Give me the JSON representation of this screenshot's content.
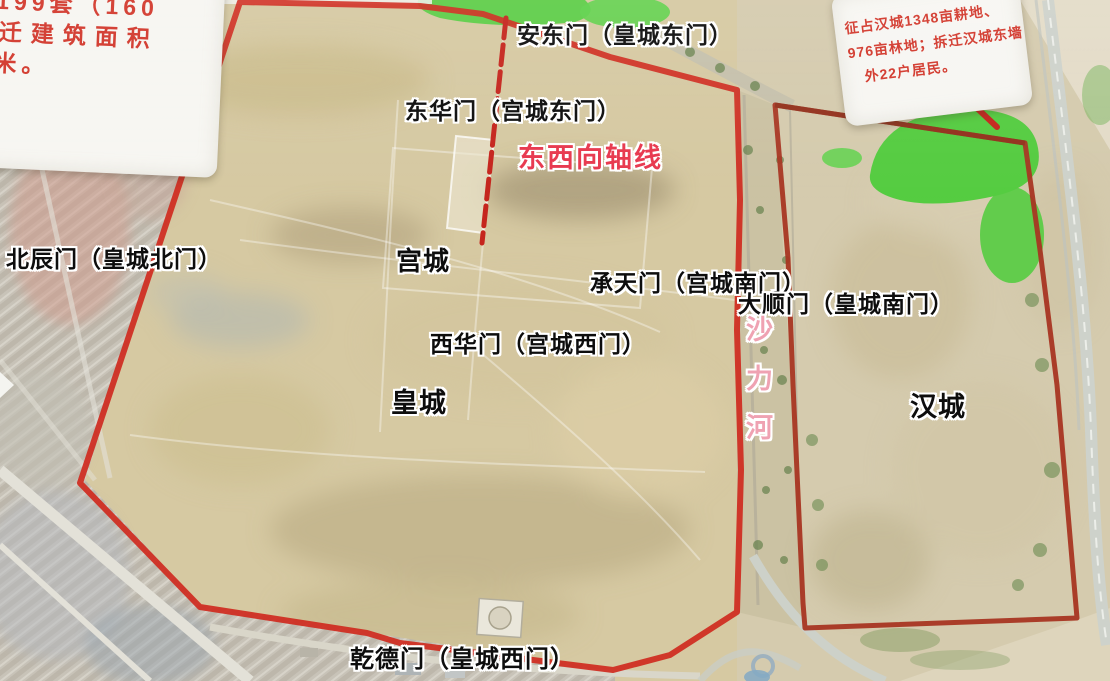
{
  "signs": {
    "top_left": {
      "lines": [
        "屋199套（160",
        "拆迁建筑面积",
        "方米。"
      ]
    },
    "top_right": {
      "lines": [
        "征占汉城1348亩耕地、",
        "976亩林地；拆迁汉城东墙",
        "外22户居民。"
      ]
    }
  },
  "labels": {
    "andongmen": "安东门（皇城东门）",
    "donghuamen": "东华门（宫城东门）",
    "axis": "东西向轴线",
    "beichenmen": "北辰门（皇城北门）",
    "gongcheng": "宫城",
    "chengtianmen": "承天门（宫城南门）",
    "dashunmen": "大顺门（皇城南门）",
    "xihuamen": "西华门（宫城西门）",
    "huangcheng": "皇城",
    "hancheng": "汉城",
    "qiandemen": "乾德门（皇城西门）",
    "river": "沙力河"
  },
  "colors": {
    "huangcheng_boundary_red": "#cf2a1e",
    "hancheng_boundary_red": "#a83522",
    "axis_line_red": "#c5251d",
    "axis_label_red": "#e8384e",
    "river_label_pink": "#efa2b2",
    "sign_text_red": "#d2372b",
    "green_area": "#55cc41",
    "terrain_tan": "#d6c9a2"
  }
}
